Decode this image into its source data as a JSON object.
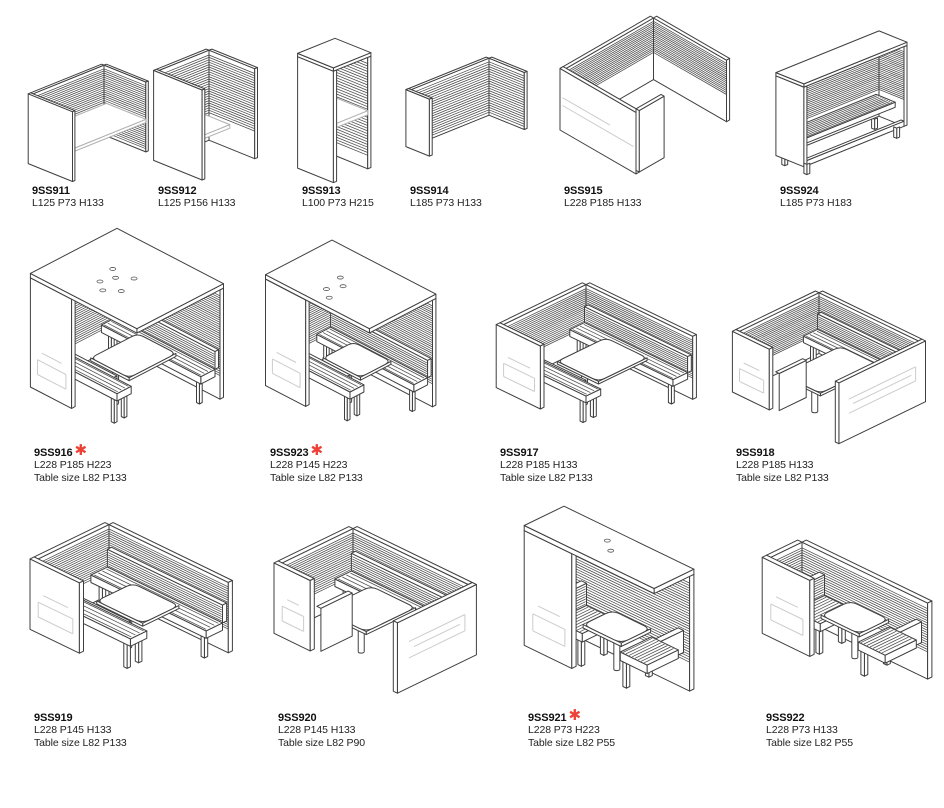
{
  "page": {
    "background": "#ffffff"
  },
  "legend": {
    "asterisk_glyph": "✱",
    "asterisk_color": "#ee4036"
  },
  "products": [
    {
      "code": "9SS911",
      "dims": "L125 P73 H133",
      "table_size": "",
      "asterisk": ""
    },
    {
      "code": "9SS912",
      "dims": "L125 P156 H133",
      "table_size": "",
      "asterisk": ""
    },
    {
      "code": "9SS913",
      "dims": "L100 P73 H215",
      "table_size": "",
      "asterisk": ""
    },
    {
      "code": "9SS914",
      "dims": "L185 P73 H133",
      "table_size": "",
      "asterisk": ""
    },
    {
      "code": "9SS915",
      "dims": "L228 P185 H133",
      "table_size": "",
      "asterisk": ""
    },
    {
      "code": "9SS924",
      "dims": "L185 P73 H183",
      "table_size": "",
      "asterisk": ""
    },
    {
      "code": "9SS916",
      "dims": "L228 P185 H223",
      "table_size": "Table size L82 P133",
      "asterisk": "✱"
    },
    {
      "code": "9SS923",
      "dims": "L228 P145 H223",
      "table_size": "Table size L82 P133",
      "asterisk": "✱"
    },
    {
      "code": "9SS917",
      "dims": "L228 P185 H133",
      "table_size": "Table size L82 P133",
      "asterisk": ""
    },
    {
      "code": "9SS918",
      "dims": "L228 P185 H133",
      "table_size": "Table size L82 P133",
      "asterisk": ""
    },
    {
      "code": "9SS919",
      "dims": "L228 P145 H133",
      "table_size": "Table size L82 P133",
      "asterisk": ""
    },
    {
      "code": "9SS920",
      "dims": "L228 P145 H133",
      "table_size": "Table size L82 P90",
      "asterisk": ""
    },
    {
      "code": "9SS921",
      "dims": "L228 P73 H223",
      "table_size": "Table size L82 P55",
      "asterisk": "✱"
    },
    {
      "code": "9SS922",
      "dims": "L228 P73 H133",
      "table_size": "Table size L82 P55",
      "asterisk": ""
    }
  ]
}
